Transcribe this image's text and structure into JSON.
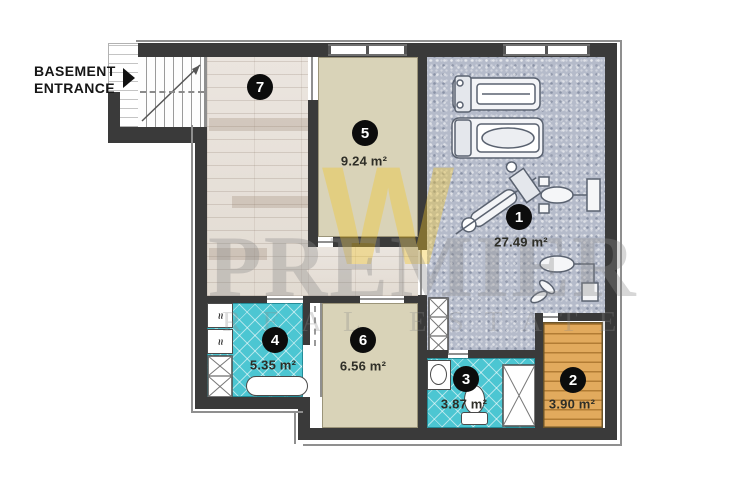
{
  "entrance": {
    "line1": "BASEMENT",
    "line2": "ENTRANCE"
  },
  "watermark": {
    "brand": "PREMIER",
    "tagline": "REAL ESTATE",
    "monogram": "W"
  },
  "rooms": [
    {
      "number": "1",
      "area": "27.49 m²",
      "name": "gym"
    },
    {
      "number": "2",
      "area": "3.90 m²",
      "name": "sauna"
    },
    {
      "number": "3",
      "area": "3.87 m²",
      "name": "bathroom"
    },
    {
      "number": "4",
      "area": "5.35 m²",
      "name": "laundry-bathroom"
    },
    {
      "number": "5",
      "area": "9.24 m²",
      "name": "storage-room"
    },
    {
      "number": "6",
      "area": "6.56 m²",
      "name": "storage-room"
    },
    {
      "number": "7",
      "area": "",
      "name": "hallway"
    }
  ],
  "fixtures": {
    "washer_glyph": "≈"
  },
  "colors": {
    "wall": "#3a3a3a",
    "tile_teal": "#4cc6d2",
    "sauna_wood": "#e0a65c",
    "hall_wood": "#e9e3dc",
    "room_beige": "#d9d3b8",
    "gym_floor": "#b5bbca",
    "badge": "#0c0c0c",
    "watermark_yellow": "#f2c628",
    "watermark_gray": "#8c8c8c"
  }
}
